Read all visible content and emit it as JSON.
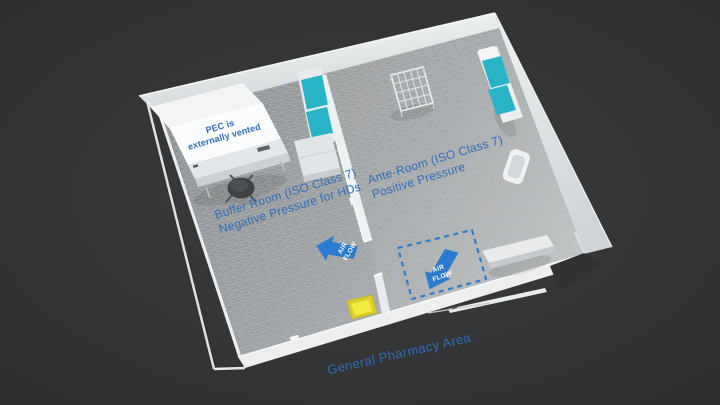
{
  "labels": {
    "pec": {
      "line1": "PEC is",
      "line2": "externally vented"
    },
    "buffer_room": {
      "line1": "Buffer Room (ISO Class 7)",
      "line2": "Negative Pressure for HDs"
    },
    "ante_room": {
      "line1": "Ante-Room (ISO Class 7)",
      "line2": "Positive Pressure"
    },
    "general_pharmacy": "General Pharmacy Area",
    "airflow_buffer": {
      "line1": "AIR",
      "line2": "FLOW"
    },
    "airflow_ante": {
      "line1": "AIR",
      "line2": "FLOW"
    }
  },
  "colors": {
    "background": "#323335",
    "label_blue": "#2f6db8",
    "arrow_blue": "#2b7bd0",
    "airflow_text": "#ffffff",
    "cushion_teal": "#29b3c7",
    "sticky_mat_yellow": "#f3ea3f",
    "sticky_mat_border": "#d9ce2a",
    "demarcation_blue": "#2e7ccc",
    "floor_gray": "#9da0a2",
    "wall_light": "#e4e7e9"
  }
}
